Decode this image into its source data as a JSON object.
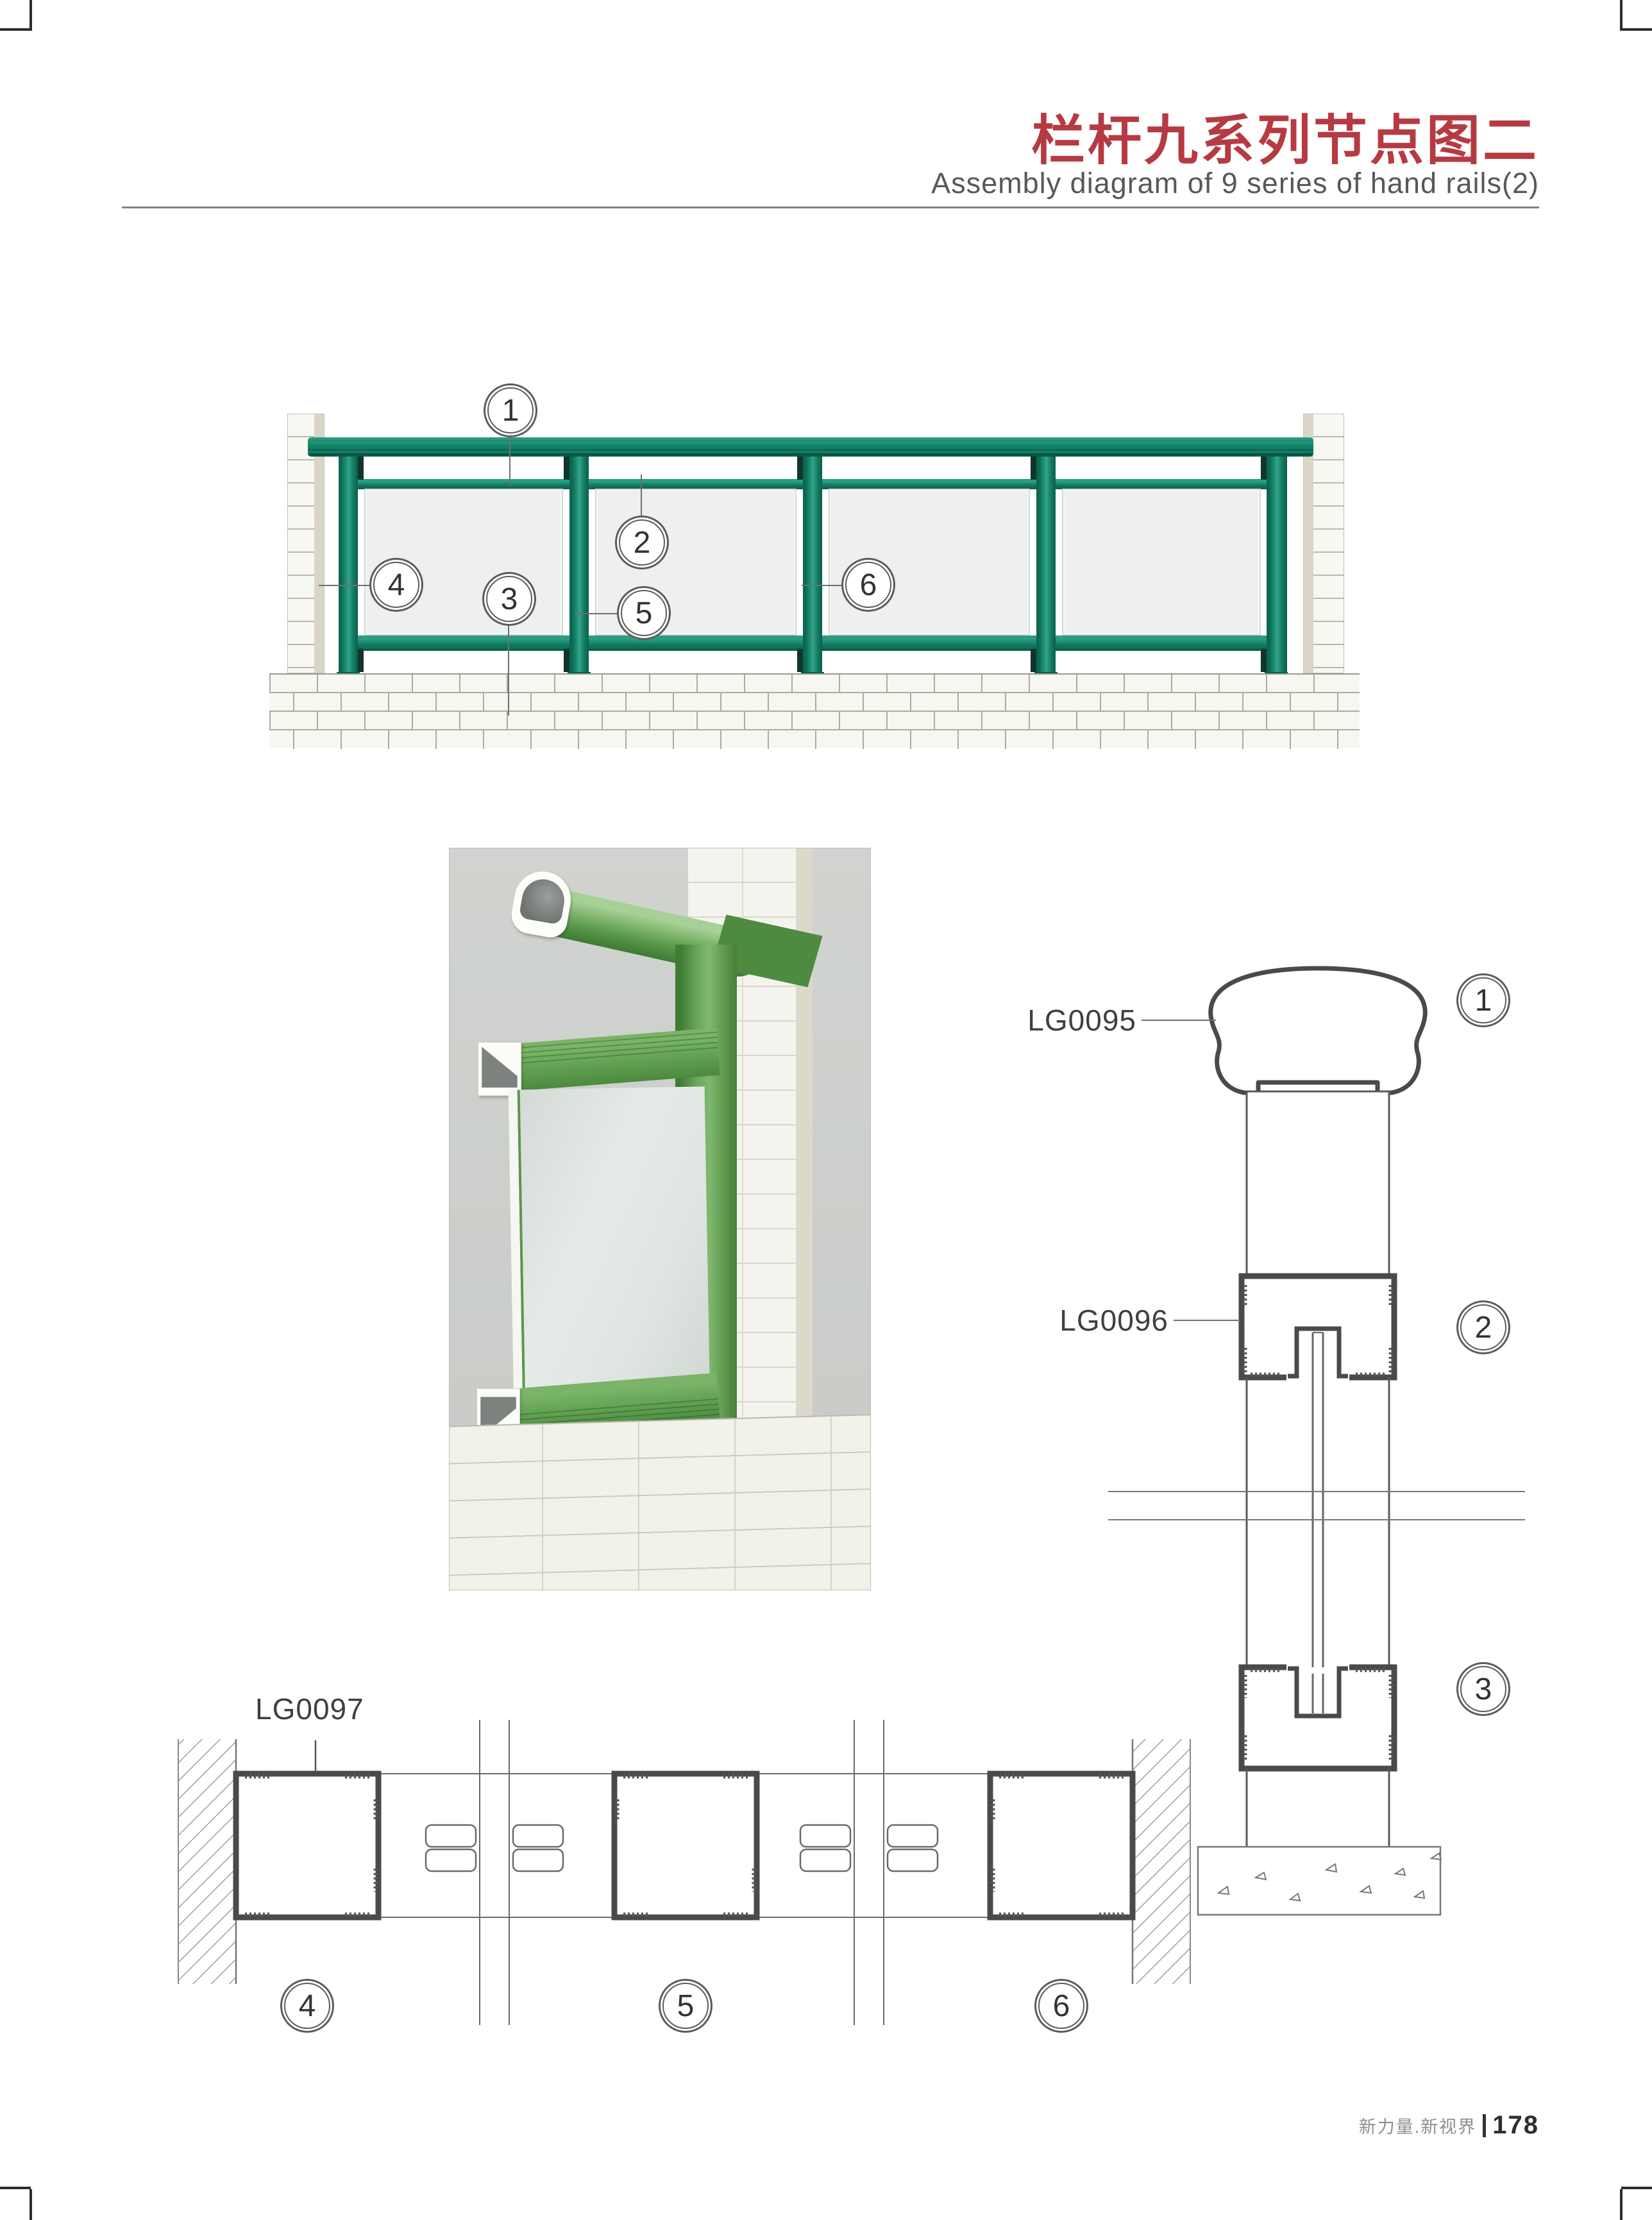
{
  "header": {
    "title_cn": "栏杆九系列节点图二",
    "title_en": "Assembly diagram of 9 series of hand rails(2)"
  },
  "elevation": {
    "callouts": [
      "1",
      "2",
      "3",
      "4",
      "5",
      "6"
    ]
  },
  "section": {
    "parts": [
      {
        "code": "LG0095",
        "callout": "1"
      },
      {
        "code": "LG0096",
        "callout": "2"
      },
      {
        "code": "",
        "callout": "3"
      }
    ]
  },
  "plan": {
    "part_code": "LG0097",
    "callouts": [
      "4",
      "5",
      "6"
    ]
  },
  "footer": {
    "brand": "新力量.新视界",
    "page_no": "178"
  },
  "colors": {
    "accent_red": "#b63a42",
    "rail_green": "#16866a",
    "render_green": "#6fae5d"
  }
}
